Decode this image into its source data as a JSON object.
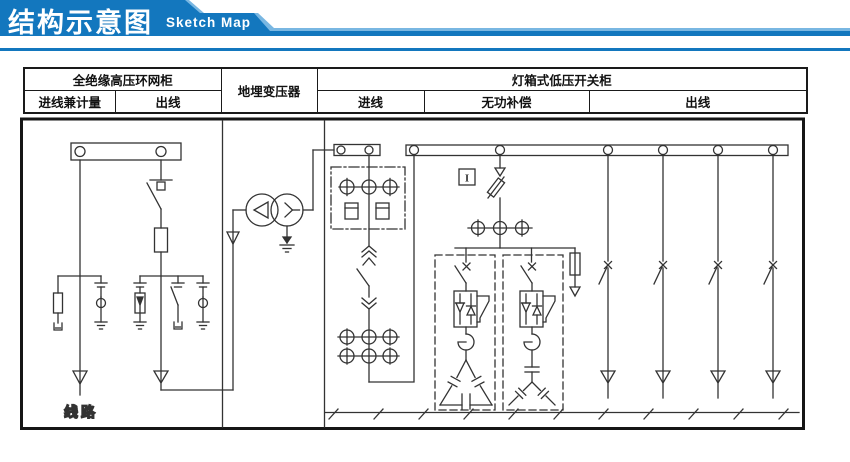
{
  "banner": {
    "title": "结构示意图",
    "subtitle": "Sketch Map",
    "accent_color": "#1377be",
    "accent_light_color": "#79b7e2"
  },
  "table": {
    "groups": [
      {
        "label": "全绝缘高压环网柜",
        "columns": [
          "进线兼计量",
          "出线"
        ]
      },
      {
        "label": "地埋变压器",
        "columns": []
      },
      {
        "label": "灯箱式低压开关柜",
        "columns": [
          "进线",
          "无功补偿",
          "出线"
        ]
      }
    ]
  },
  "diagram": {
    "line_label": "线路",
    "instrument_label": "I",
    "stroke_color": "#333333"
  }
}
